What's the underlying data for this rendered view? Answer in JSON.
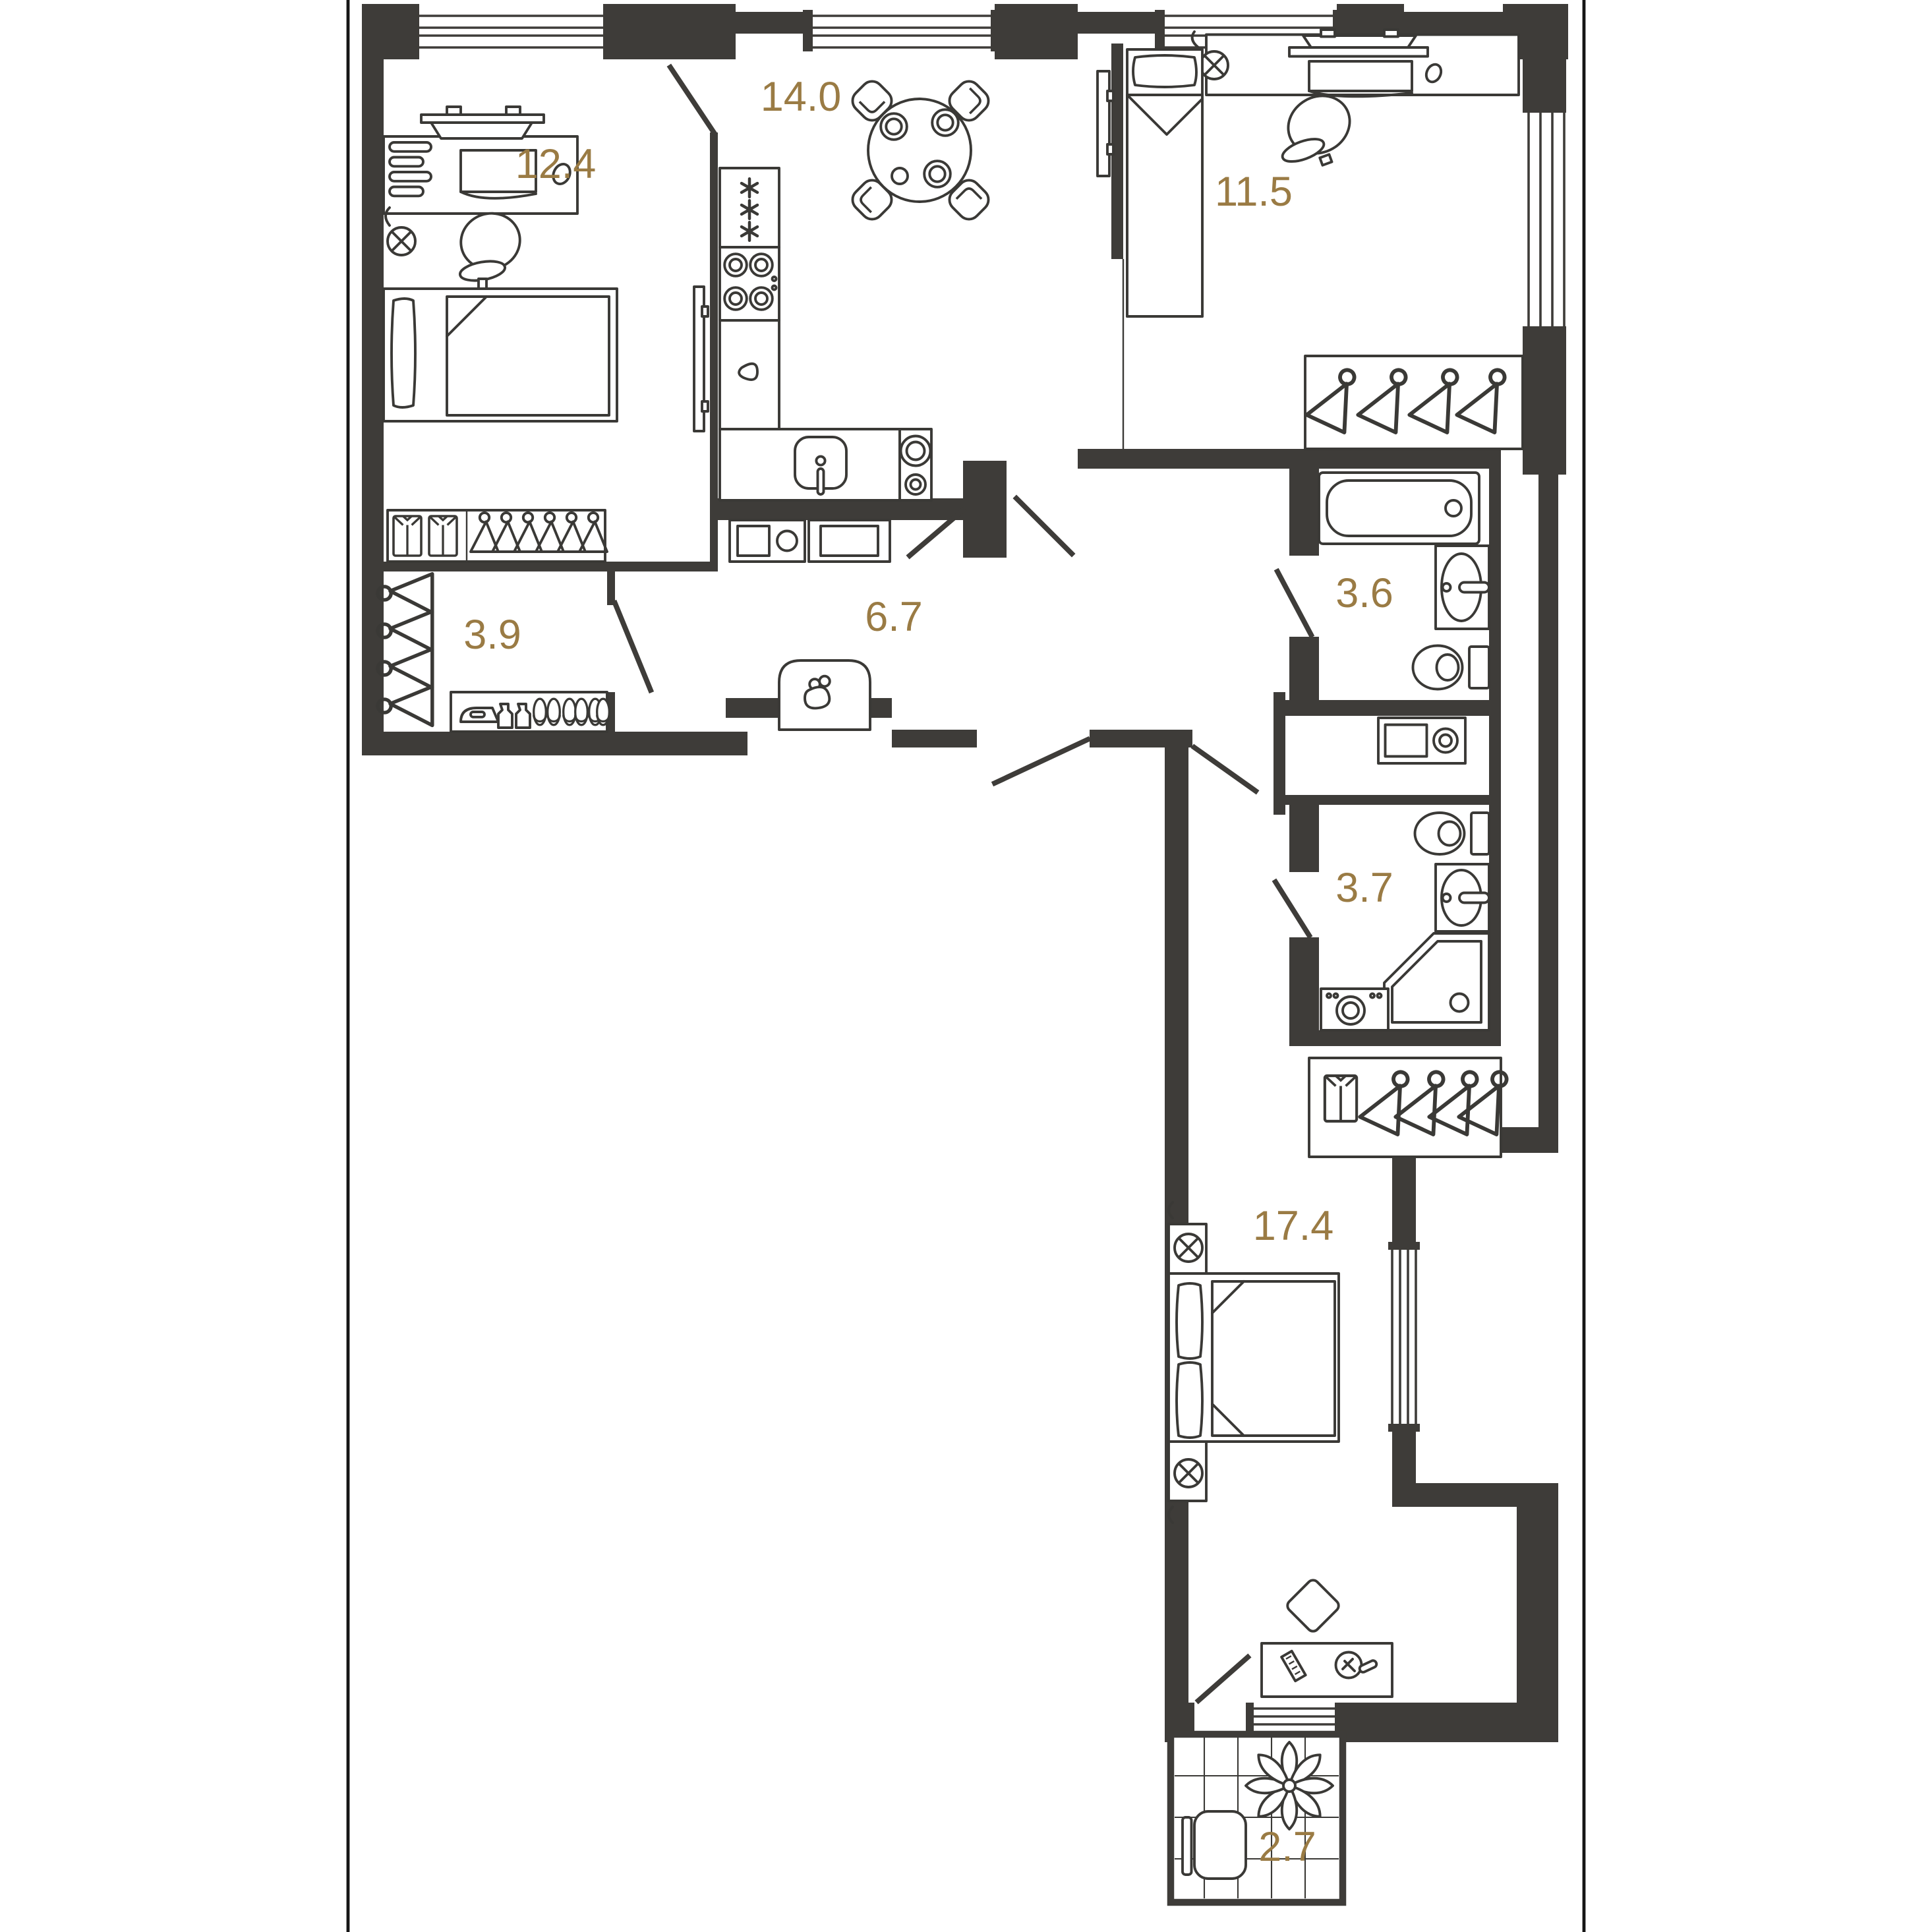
{
  "plan": {
    "type": "apartment-floor-plan",
    "background": "#ffffff",
    "wall_color": "#3E3C39",
    "furniture_line_color": "#3A3936",
    "label_color": "#9A7B44",
    "rooms": [
      {
        "name": "bedroom-top-left",
        "area": "12.4",
        "furniture": [
          "desk",
          "monitor",
          "desk-shelves",
          "desk-chair",
          "wall-lamp",
          "single-bed",
          "wardrobe-with-hangers",
          "tv-panel"
        ]
      },
      {
        "name": "kitchen-dining",
        "area": "14.0",
        "furniture": [
          "fridge",
          "cooktop",
          "cabinet",
          "sink",
          "counter",
          "round-table",
          "four-chairs",
          "tv-panel",
          "washer",
          "dishwasher"
        ]
      },
      {
        "name": "bedroom-top-right",
        "area": "11.5",
        "furniture": [
          "single-bed",
          "desk",
          "laptop",
          "printer",
          "wall-lamp",
          "desk-chair",
          "mouse",
          "wardrobe-with-hangers"
        ]
      },
      {
        "name": "walk-in-closet",
        "area": "3.9",
        "furniture": [
          "hangers-rail",
          "shelf",
          "iron",
          "spray-bottles",
          "slippers"
        ]
      },
      {
        "name": "hallway",
        "area": "6.7",
        "furniture": [
          "pouf-with-bag"
        ]
      },
      {
        "name": "bathroom",
        "area": "3.6",
        "furniture": [
          "bathtub",
          "washbasin",
          "toilet",
          "washing-machine"
        ]
      },
      {
        "name": "shower-room",
        "area": "3.7",
        "furniture": [
          "toilet",
          "washbasin",
          "corner-shower",
          "washing-machine"
        ]
      },
      {
        "name": "bedroom-master",
        "area": "17.4",
        "furniture": [
          "double-bed",
          "two-nightstands",
          "two-wall-lamps",
          "dressing-desk",
          "mirror",
          "comb",
          "chair",
          "wardrobe-with-hangers"
        ]
      },
      {
        "name": "balcony",
        "area": "2.7",
        "furniture": [
          "tiled-floor",
          "plant",
          "seat"
        ]
      }
    ]
  }
}
